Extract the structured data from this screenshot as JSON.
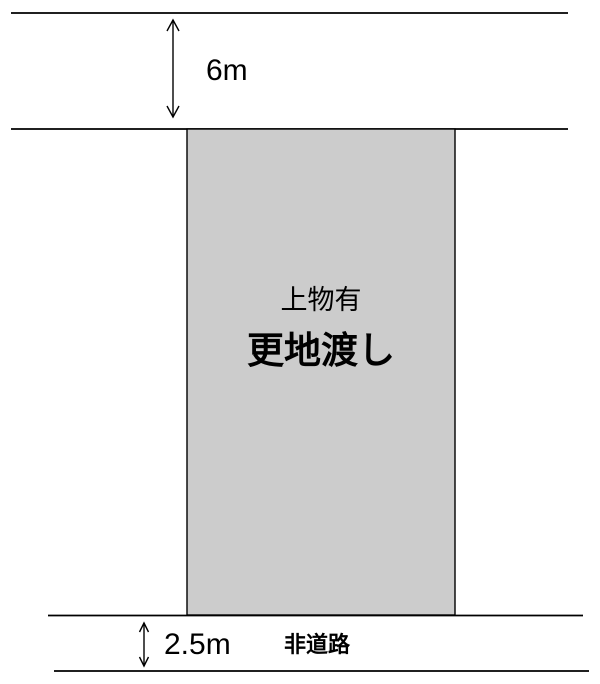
{
  "diagram": {
    "top_dimension": {
      "label": "6m"
    },
    "plot": {
      "structures_label": "上物有",
      "delivery_label": "更地渡し"
    },
    "bottom_dimension": {
      "label": "2.5m"
    },
    "road_label": "非道路",
    "colors": {
      "plot_fill": "#cccccc",
      "line": "#000000",
      "background": "#ffffff",
      "text": "#000000"
    }
  }
}
